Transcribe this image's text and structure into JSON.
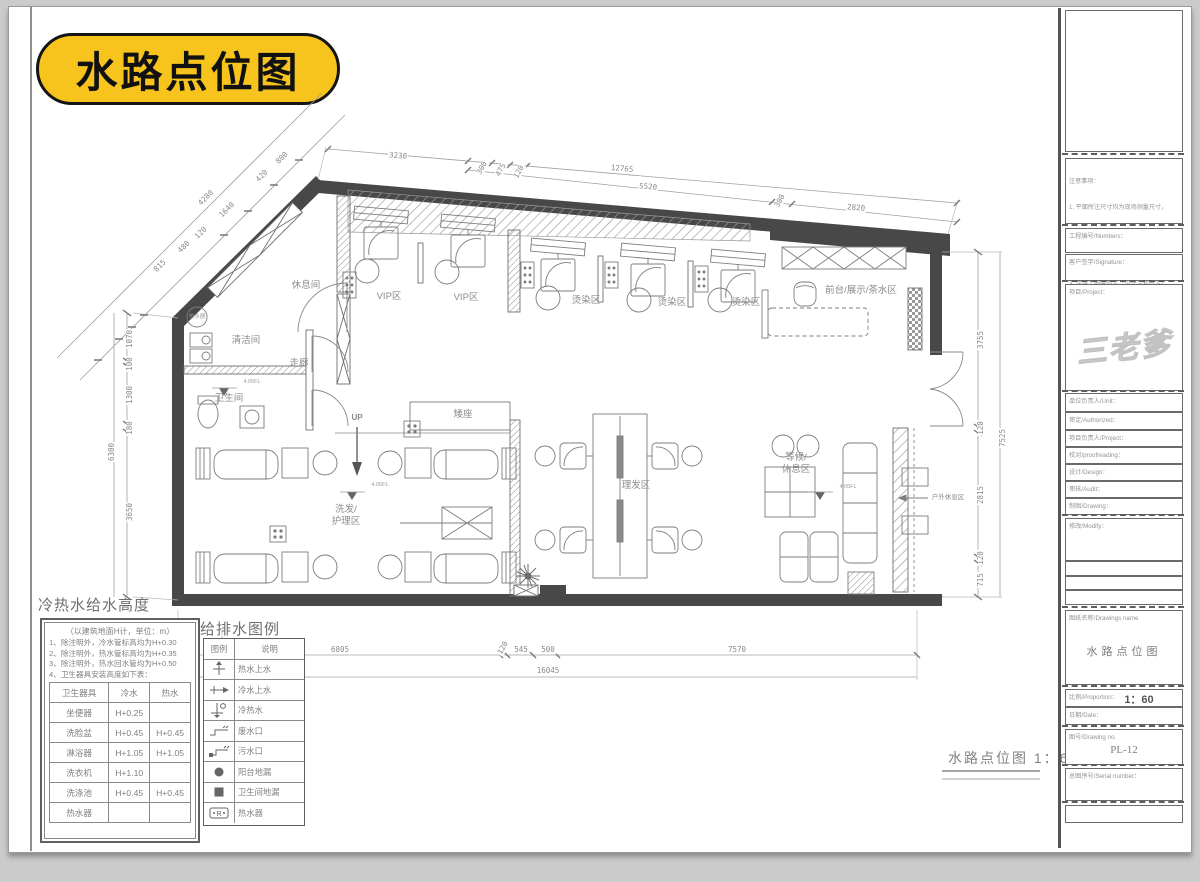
{
  "page": {
    "badge": "水路点位图"
  },
  "plan": {
    "labels": {
      "rest_room": "休息间",
      "vip1": "VIP区",
      "vip2": "VIP区",
      "perm1": "烫染区",
      "perm2": "烫染区",
      "perm3": "烫染区",
      "front_desk": "前台/展示/茶水区",
      "cleaning": "清洁间",
      "corridor": "走廊",
      "toilet": "卫生间",
      "water_heater": "热水器",
      "up": "UP",
      "low_seat": "矮座",
      "haircut": "理发区",
      "wash": "洗发/\n护理区",
      "waiting": "等候/\n休息区",
      "outdoor": "户外休息区",
      "elev": "4.05FL"
    },
    "caption": "水路点位图 1：60"
  },
  "dims": {
    "top": [
      "3230",
      "300",
      "475",
      "120",
      "12765",
      "5520",
      "300",
      "2820"
    ],
    "diag": [
      "4280",
      "815",
      "480",
      "120",
      "1640",
      "420",
      "800"
    ],
    "left": [
      "1070",
      "100",
      "1300",
      "180",
      "3650",
      "6300"
    ],
    "right": [
      "3755",
      "120",
      "2815",
      "120",
      "715",
      "7525"
    ],
    "bottom": [
      "6805",
      "120",
      "545",
      "500",
      "7570",
      "16045"
    ],
    "misc": [
      "320"
    ]
  },
  "height_table": {
    "title": "冷热水给水高度",
    "subtitle": "（以建筑地面H计，单位：m）",
    "notes": [
      "1、除注明外，冷水管标高均为H+0.30",
      "2、除注明外，热水管标高均为H+0.35",
      "3、除注明外，热水回水管均为H+0.50",
      "4、卫生器具安装高度如下表："
    ],
    "headers": [
      "卫生器具",
      "冷水",
      "热水"
    ],
    "rows": [
      [
        "坐便器",
        "H+0.25",
        ""
      ],
      [
        "洗脸盆",
        "H+0.45",
        "H+0.45"
      ],
      [
        "淋浴器",
        "H+1.05",
        "H+1.05"
      ],
      [
        "洗衣机",
        "H+1.10",
        ""
      ],
      [
        "洗涤池",
        "H+0.45",
        "H+0.45"
      ],
      [
        "热水器",
        "",
        ""
      ]
    ]
  },
  "legend": {
    "title": "给排水图例",
    "headers": [
      "图例",
      "说明"
    ],
    "rows": [
      {
        "icon": "hot-water-supply-symbol",
        "label": "热水上水"
      },
      {
        "icon": "cold-water-supply-symbol",
        "label": "冷水上水"
      },
      {
        "icon": "hot-cold-water-symbol",
        "label": "冷热水"
      },
      {
        "icon": "waste-water-outlet-symbol",
        "label": "废水口"
      },
      {
        "icon": "sewage-outlet-symbol",
        "label": "污水口"
      },
      {
        "icon": "balcony-drain-symbol",
        "label": "阳台地漏"
      },
      {
        "icon": "toilet-drain-symbol",
        "label": "卫生间地漏"
      },
      {
        "icon": "water-heater-symbol",
        "label": "热水器"
      }
    ]
  },
  "title_block": {
    "notes_title": "注意事项：",
    "notes": [
      "1. 平面所注尺寸均为现场测量尺寸，",
      "    如有误差，按实际调整。",
      "2. 尺寸不明时以现场为准。",
      "3. 该施工图需双方（设计方和甲方）",
      "    签字认可后，方可施工。"
    ],
    "fields": {
      "numbers": "工程编号/Numbers：",
      "signature": "客户签字/Signature：",
      "project": "项目/Project：",
      "watermark": "三老爹",
      "unit": "单位负责人/Unit：",
      "authorized": "审定/Authorized：",
      "project_leader": "项目负责人/Project：",
      "proofreading": "校对/proofreading：",
      "design": "设计/Design：",
      "audit": "审核/Audit：",
      "drawing": "制图/Drawing：",
      "modify": "修改/Modify：",
      "drawing_name_label": "图纸名称/Drawings name",
      "drawing_name": "水路点位图",
      "proportion_label": "比例/Proportion：",
      "proportion_value": "1：60",
      "date": "日期/Date：",
      "drawing_no_label": "图号/Drawing no.",
      "drawing_no": "PL-12",
      "serial": "总图序号/Serial number："
    }
  },
  "colors": {
    "badge_yellow": "#F7C41D",
    "wall_dark": "#484848",
    "line_gray": "#8a8a8a"
  }
}
